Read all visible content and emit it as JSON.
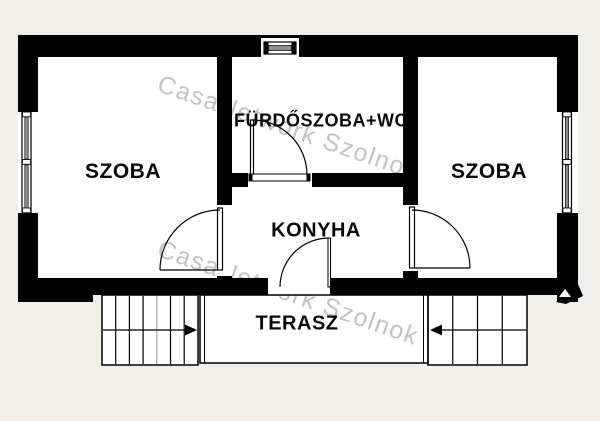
{
  "floorplan": {
    "labels": {
      "room_left": "SZOBA",
      "bathroom": "FÜRDŐSZOBA+WC",
      "room_right": "SZOBA",
      "kitchen": "KONYHA",
      "terrace": "TERASZ"
    },
    "watermark": {
      "text": "CasaNetwork Szolnok",
      "color": "#c3c2bd"
    },
    "icons": {
      "stairs_left_arrow": "arrow-right",
      "stairs_right_arrow": "arrow-left"
    },
    "colors": {
      "wall": "#000000",
      "floor": "#ffffff",
      "background": "#f1efe9",
      "window_glass": "#8f8f8f"
    }
  }
}
